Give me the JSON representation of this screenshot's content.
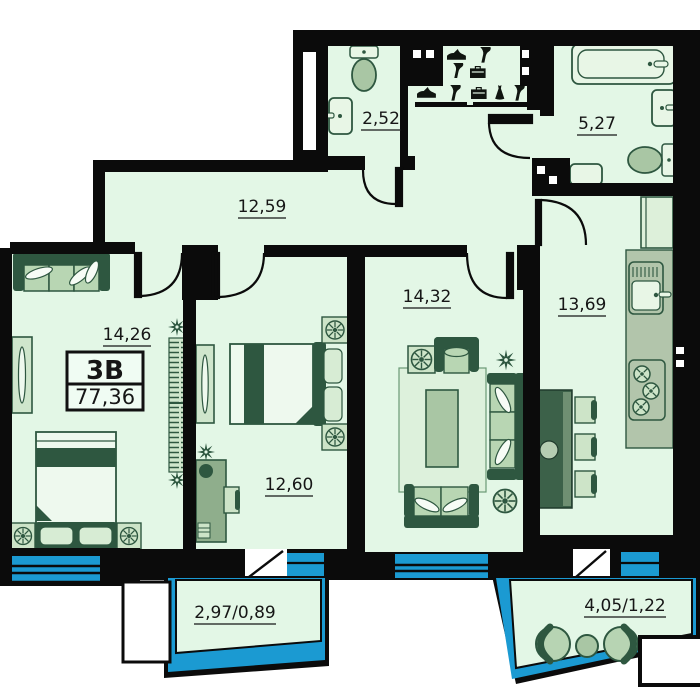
{
  "plan": {
    "title": "apartment-floor-plan",
    "unit": {
      "type_label": "3B",
      "total_area": "77,36"
    },
    "rooms": {
      "hallway": {
        "label": "12,59"
      },
      "wc": {
        "label": "2,52"
      },
      "bathroom": {
        "label": "5,27"
      },
      "bedroom_left": {
        "label": "14,26"
      },
      "bedroom_middle": {
        "label": "12,60"
      },
      "living_room": {
        "label": "14,32"
      },
      "kitchen": {
        "label": "13,69"
      },
      "balcony_left": {
        "label": "2,97/0,89"
      },
      "balcony_right": {
        "label": "4,05/1,22"
      }
    },
    "colors": {
      "floor": "#e3f7e6",
      "wall": "#0b0b0b",
      "furniture_dark": "#2e5740",
      "furniture_light": "#c2dcbc",
      "glazing_blue": "#1b9ad2",
      "text": "#161616"
    }
  }
}
